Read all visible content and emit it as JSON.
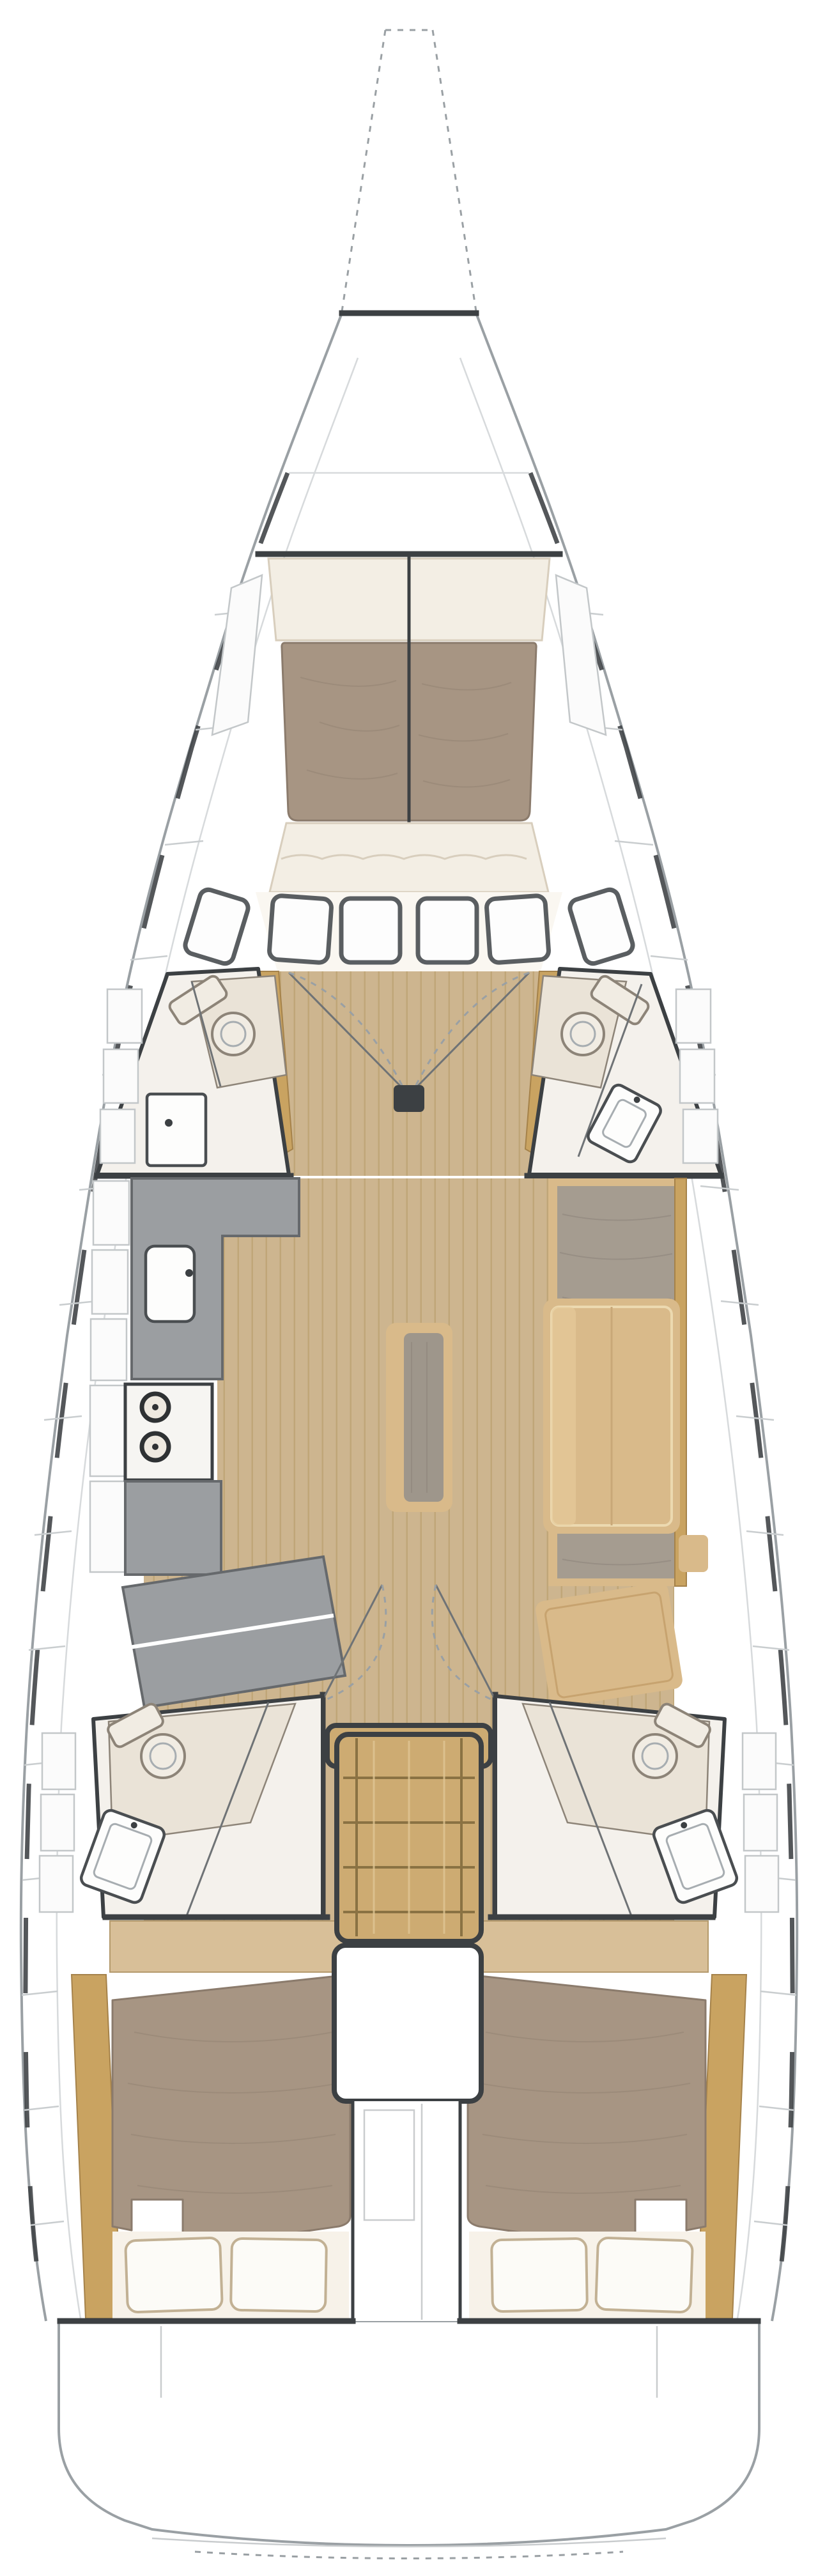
{
  "diagram": {
    "type": "sailing-yacht-interior-floor-plan",
    "orientation": "bow-up",
    "view": "top-down deck plan, no text labels",
    "rooms": [
      {
        "id": "forward-cabin",
        "features": [
          "v-berth-double",
          "foot-cushions",
          "hull-shelves",
          "deck-hatches"
        ]
      },
      {
        "id": "port-forward-head",
        "features": [
          "toilet",
          "storage-cabinet",
          "hull-lockers"
        ]
      },
      {
        "id": "starboard-forward-head",
        "features": [
          "toilet",
          "vanity-sink",
          "hull-lockers"
        ]
      },
      {
        "id": "galley-port",
        "features": [
          "l-shaped-counter",
          "sink",
          "two-burner-stove",
          "lower-counter",
          "angled-cabinet"
        ]
      },
      {
        "id": "saloon",
        "features": [
          "dining-table",
          "center-bench",
          "starboard-settee",
          "chart-table"
        ]
      },
      {
        "id": "companionway",
        "features": [
          "stairs-5-steps",
          "engine-compartment"
        ]
      },
      {
        "id": "port-aft-head",
        "features": [
          "toilet",
          "vanity-sink",
          "shower-floor"
        ]
      },
      {
        "id": "starboard-aft-head",
        "features": [
          "toilet",
          "vanity-sink",
          "shower-floor"
        ]
      },
      {
        "id": "port-aft-cabin",
        "features": [
          "double-berth",
          "two-pillows",
          "headboard-shelf",
          "hull-lockers"
        ]
      },
      {
        "id": "starboard-aft-cabin",
        "features": [
          "double-berth",
          "two-pillows",
          "headboard-shelf",
          "hull-lockers"
        ]
      },
      {
        "id": "transom",
        "features": [
          "swim-platform"
        ]
      }
    ],
    "door_swings_shown": 4,
    "mast_step_shown": true
  },
  "colors": {
    "paper": "#ffffff",
    "hull-line": "#9aa0a4",
    "deck-seam": "#d7dadc",
    "tick": "#c9cdcf",
    "wall": "#3c4043",
    "wood-base": "#cdb58f",
    "wood-line": "#c0a678",
    "trim-gold": "#c9a361",
    "mattress": "#a79583",
    "mattress-line": "#8b7b6c",
    "cushion": "#f3eee4",
    "cushion-edge": "#d8cebd",
    "counter": "#9b9ea1",
    "counter-edge": "#66696c",
    "sofa": "#a59c90",
    "sofa-line": "#8c837a",
    "furn-wood": "#d9ba8a",
    "stairs": "#cdab72",
    "stairs-line": "#8a7243",
    "fixture": "#fdfdfc",
    "fixture-edge": "#4a4e51",
    "room-floor": "#f4f1ec",
    "toilet-zone": "#eae3d7",
    "toilet-edge": "#8d8478",
    "window-frame": "#5a5e61",
    "headboard": "#d8bf98",
    "pillow": "#fcfbf7",
    "pillow-edge": "#c2b194"
  }
}
